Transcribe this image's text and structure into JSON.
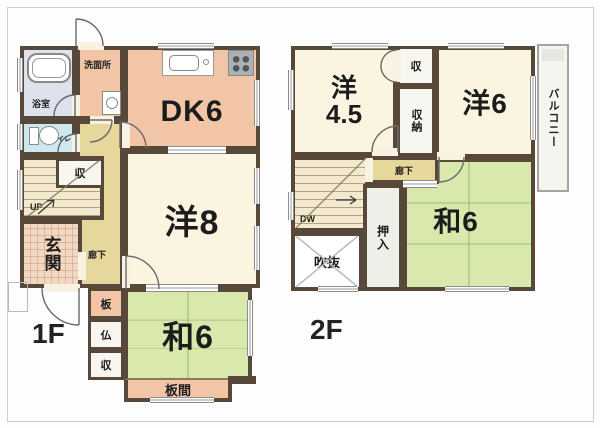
{
  "frame": {
    "floor1_label": "1F",
    "floor2_label": "2F"
  },
  "floor1": {
    "bath": "浴室",
    "washroom": "洗面所",
    "dining_kitchen": "DK6",
    "toilet": "トイレ",
    "stair_storage": "収",
    "up": "UP",
    "entrance": "玄関",
    "hallway": "廊下",
    "western8": "洋8",
    "board": "板",
    "altar": "仏",
    "storage": "収",
    "japanese6": "和6",
    "board_floor": "板間"
  },
  "floor2": {
    "western45_l1": "洋",
    "western45_l2": "4.5",
    "closet": "収",
    "storage": "収納",
    "western6": "洋6",
    "balcony": "バルコニー",
    "down": "DW",
    "hallway": "廊下",
    "void": "吹抜",
    "futon_closet": "押入",
    "japanese6": "和6"
  },
  "colors": {
    "wall": "#57483a",
    "cream": "#fbf4e1",
    "wood_salmon": "#f2c5a7",
    "tatami": "#d9e9ae",
    "hall": "#e6d79c",
    "stairs": "#f2e9cf",
    "bath": "#dde2ec",
    "toilet_room": "#cde8ef",
    "entrance_tile": "#f1d8c2",
    "closet_white": "#f7f6f1",
    "balcony": "#f5f5f0"
  }
}
